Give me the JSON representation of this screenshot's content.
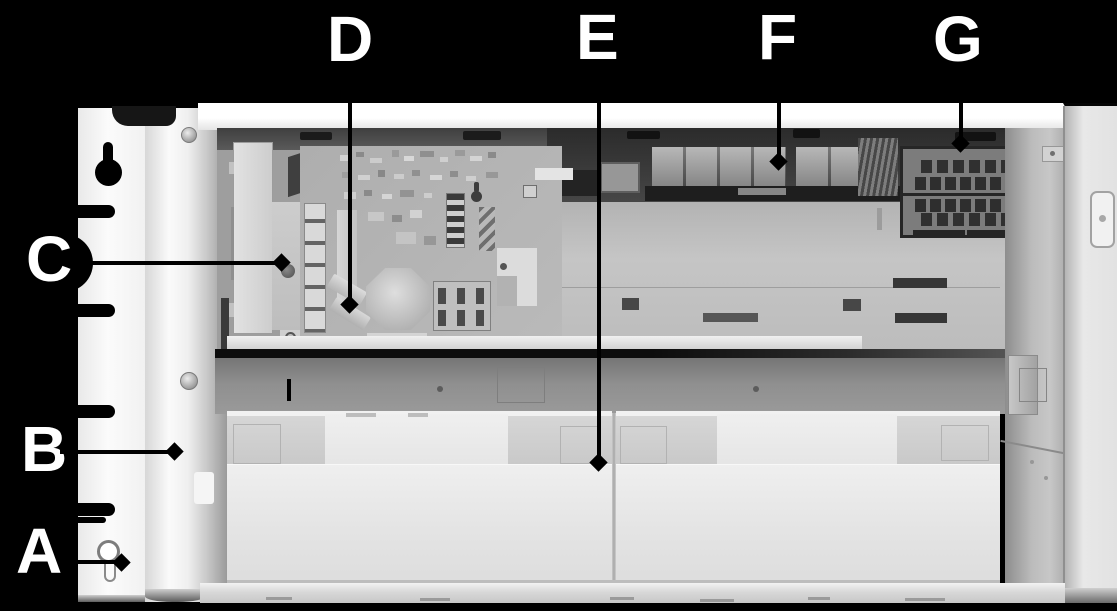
{
  "diagram": {
    "colors": {
      "background": "#000000",
      "label_text": "#ffffff",
      "leader_line": "#000000",
      "marker": "#000000"
    },
    "marker_shape": "diamond",
    "labels": [
      {
        "letter": "A"
      },
      {
        "letter": "B"
      },
      {
        "letter": "C"
      },
      {
        "letter": "D"
      },
      {
        "letter": "E"
      },
      {
        "letter": "F"
      },
      {
        "letter": "G"
      }
    ]
  }
}
